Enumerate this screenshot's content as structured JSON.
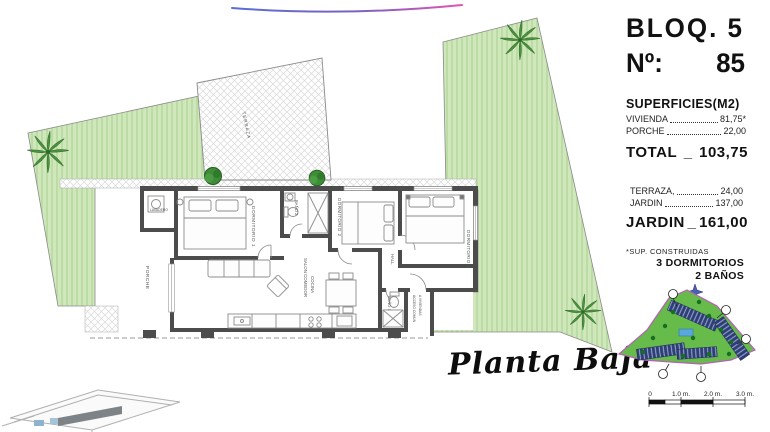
{
  "header": {
    "bloq": "BLOQ. 5",
    "numero_label": "Nº:",
    "numero_value": "85"
  },
  "superficies": {
    "title": "SUPERFICIES(M2)",
    "items": [
      {
        "label": "VIVIENDA",
        "value": "81,75*"
      },
      {
        "label": "PORCHE",
        "value": "22,00"
      }
    ],
    "total": {
      "label": "TOTAL",
      "sep": "_",
      "value": "103,75"
    },
    "items2": [
      {
        "label": "TERRAZA,",
        "value": "24,00"
      },
      {
        "label": "JARDIN",
        "value": "137,00"
      }
    ],
    "jardin_total": {
      "label": "JARDIN",
      "sep": "_",
      "value": "161,00"
    },
    "footnote": "*SUP. CONSTRUIDAS",
    "features": [
      "3 DORMITORIOS",
      "2 BAÑOS"
    ]
  },
  "plan": {
    "title": "Planta Baja",
    "rooms": {
      "porche": "PORCHE",
      "lavadero": "LAVADERO",
      "dormitorio1": "DORMITORIO 1",
      "bano2": "BAÑO 2",
      "dormitorio2": "DORMITORIO 2",
      "dormitorio3": "DORMITORIO 3",
      "salon": "SALON COMEDOR",
      "cocina": "COCINA",
      "hall": "HALL",
      "bano1": "BAÑO 1",
      "acceso1": "ACCESO COMUN",
      "acceso2": "A VIVIENDAS",
      "terraza": "TERRAZA"
    }
  },
  "scalebar": {
    "labels": [
      "0",
      "1.0 m.",
      "2.0 m.",
      "3.0 m."
    ]
  },
  "colors": {
    "garden_fill": "#cfe7ba",
    "garden_stripe": "#aed495",
    "wall": "#4c4c4c",
    "swoosh_blue": "#5b6fd4",
    "swoosh_pink": "#e254b4",
    "sitemap_green": "#66bb4a",
    "sitemap_boundary": "#b75fb7",
    "building_block": "#2e3f76",
    "pool_blue": "#58a7dd"
  }
}
